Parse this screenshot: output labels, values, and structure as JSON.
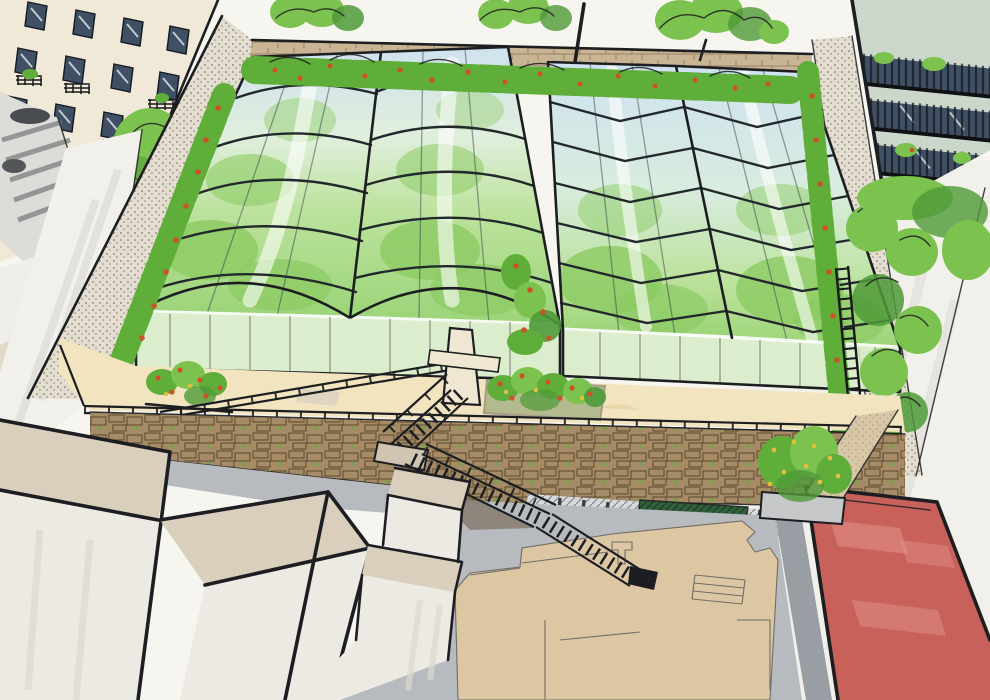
{
  "scene": {
    "title": "hand-drawn aerial concept sketch of a rooftop greenhouse farm",
    "elements": [
      "apartment-building-top-left",
      "balcony-tower-top-right",
      "rooftop-greenhouse-left",
      "rooftop-greenhouse-right",
      "perimeter-brick-wall",
      "tomato-planters",
      "flower-hedge",
      "terrace-walkway",
      "terrace-railing",
      "stone-retaining-wall",
      "switchback-stairs",
      "street-plaza",
      "site-plan-underlay",
      "red-roof-building",
      "street-trees",
      "foreground-rooftops"
    ]
  },
  "colors": {
    "sky": "#f7f5f0",
    "street_white": "#f2f0ea",
    "facade_cream": "#f0e9d7",
    "window_slate": "#3f5064",
    "ink": "#1c1e21",
    "rib_ink": "#23282c",
    "tree_green": "#7cc24f",
    "tree_dark": "#4f9a38",
    "hedge_green": "#5fae3a",
    "tomato_red": "#cc5229",
    "flower_yellow": "#e0bf3e",
    "glass_sky": "#cfe2ef",
    "glass_green": "#bce29c",
    "crop_green": "#8ccb63",
    "wall_stipple": "#e4ded1",
    "brick_tan": "#c9b593",
    "stone_brown": "#a58c66",
    "stone_line": "#5a492f",
    "terrace_cream": "#f1e4bf",
    "pavement_gray": "#b7bbc0",
    "plan_tan": "#ddc7a3",
    "curb_gray": "#989ea4",
    "roof_red": "#c7615a",
    "roof_red_light": "#e2938c",
    "sage": "#ccd7cc",
    "canopy_green": "#33603c",
    "foreground_white": "#edeae3",
    "foreground_beige": "#d9cfbc",
    "landing_tan": "#cfc5b0"
  }
}
